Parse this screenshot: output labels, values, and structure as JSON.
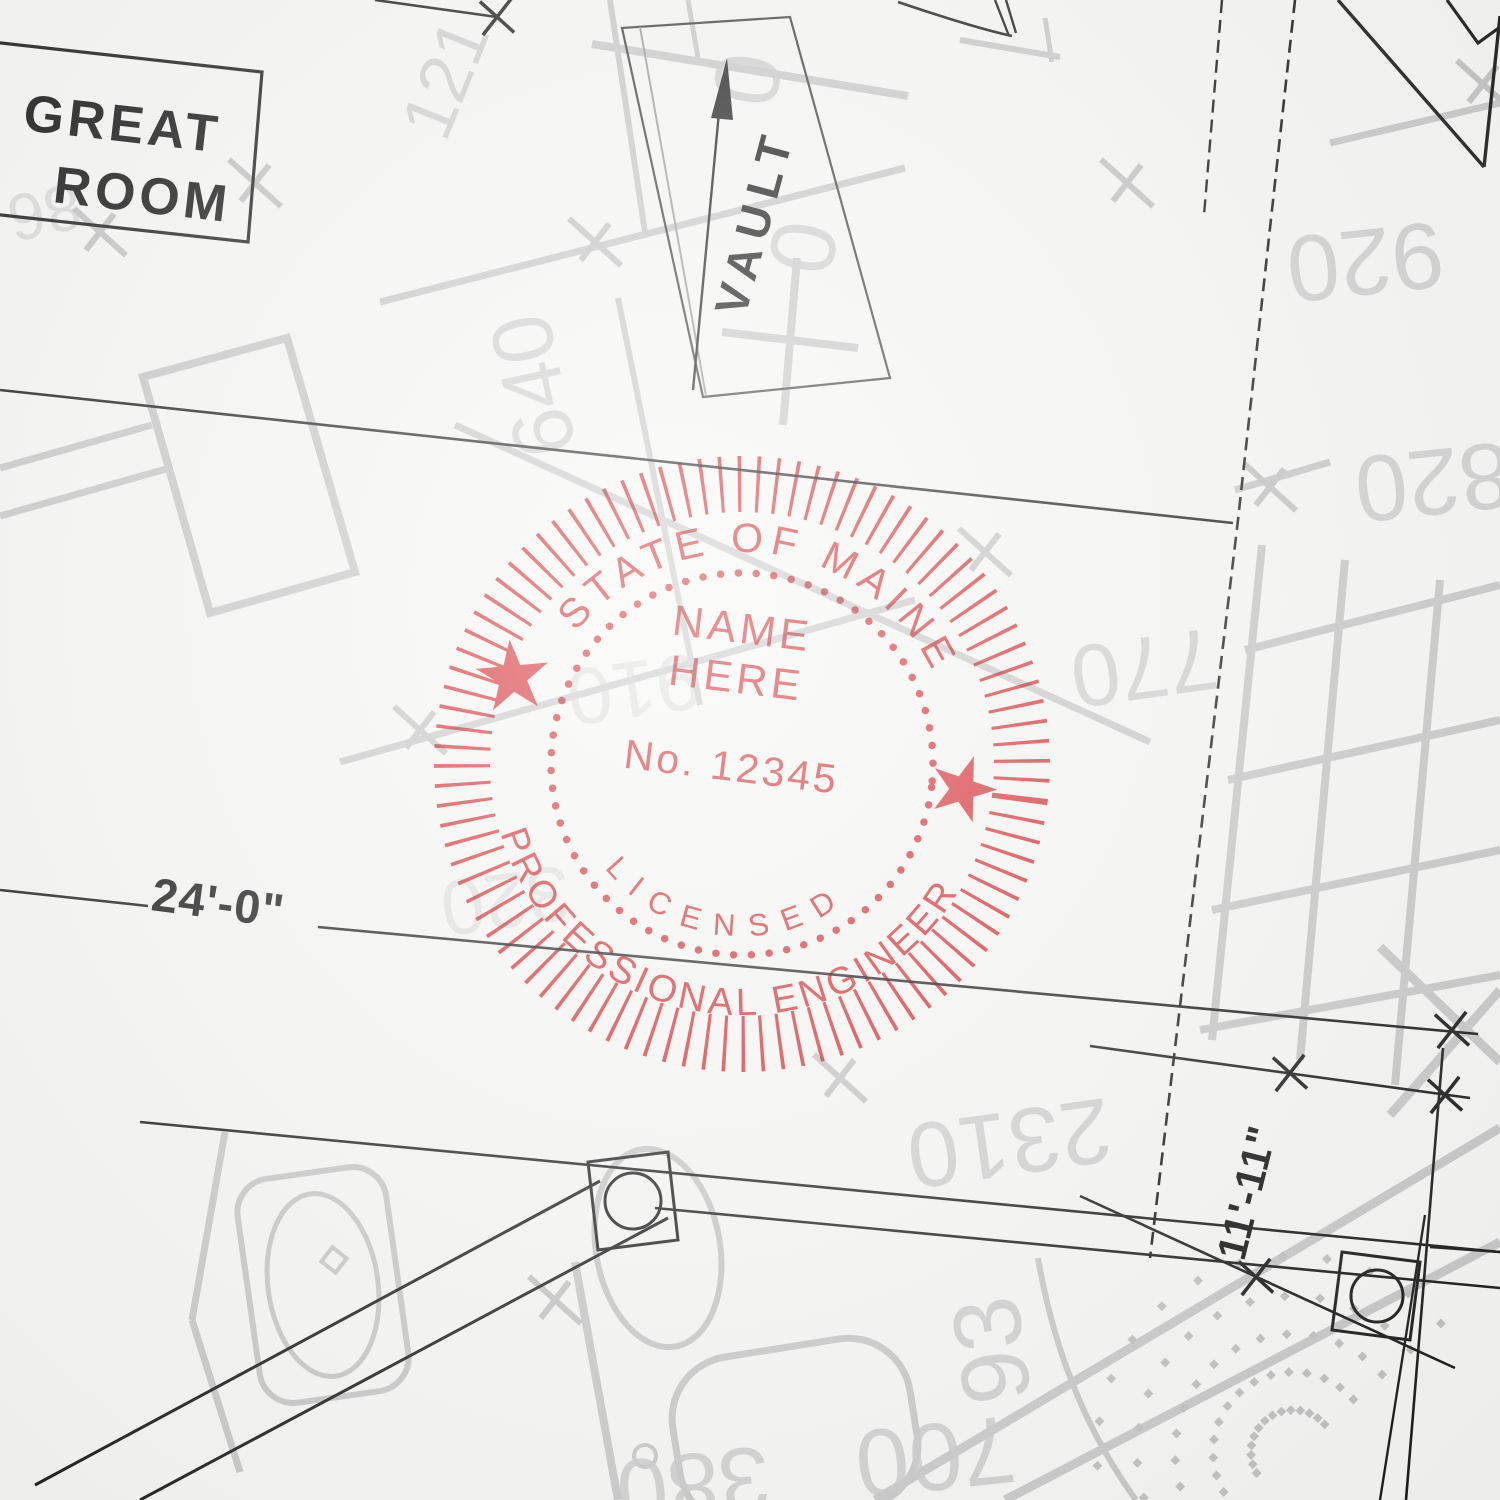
{
  "blueprint": {
    "room_label_line1": "GREAT",
    "room_label_line2": "ROOM",
    "vault_label": "VAULT",
    "dim_width": "24'-0\"",
    "dim_height": "11'-11\"",
    "ghost_numbers": [
      {
        "t": "121",
        "x": 468,
        "y": 88,
        "r": -68,
        "s": 72
      },
      {
        "t": "0",
        "x": 716,
        "y": 74,
        "r": 100,
        "s": 92
      },
      {
        "t": "0",
        "x": 772,
        "y": 242,
        "r": 100,
        "s": 92
      },
      {
        "t": "640",
        "x": 562,
        "y": 380,
        "r": -102,
        "s": 86
      },
      {
        "t": "920",
        "x": 1362,
        "y": 230,
        "r": 174,
        "s": 94
      },
      {
        "t": "820",
        "x": 1430,
        "y": 450,
        "r": 174,
        "s": 94
      },
      {
        "t": "770",
        "x": 1140,
        "y": 638,
        "r": 172,
        "s": 88
      },
      {
        "t": "910",
        "x": 630,
        "y": 662,
        "r": 172,
        "s": 80,
        "o": 0.5
      },
      {
        "t": "320",
        "x": 502,
        "y": 874,
        "r": 172,
        "s": 78,
        "o": 0.5
      },
      {
        "t": "2310",
        "x": 1005,
        "y": 1112,
        "r": 172,
        "s": 92
      },
      {
        "t": "93",
        "x": 1024,
        "y": 1346,
        "r": -98,
        "s": 96
      },
      {
        "t": "700",
        "x": 932,
        "y": 1424,
        "r": 174,
        "s": 96
      },
      {
        "t": "380",
        "x": 690,
        "y": 1454,
        "r": 174,
        "s": 92
      },
      {
        "t": "86",
        "x": 40,
        "y": 190,
        "r": 168,
        "s": 66,
        "o": 0.6
      }
    ]
  },
  "stamp": {
    "arc_top": "STATE OF MAINE",
    "center_line1": "NAME",
    "center_line2": "HERE",
    "license_number": "No. 12345",
    "arc_inner_bottom": "LICENSED",
    "arc_bottom": "PROFESSIONAL ENGINEER",
    "ink_color": "#de2027"
  },
  "decor": {
    "gray_ticks": [
      [
        255,
        183
      ],
      [
        100,
        232
      ],
      [
        420,
        730
      ],
      [
        595,
        242
      ],
      [
        985,
        552
      ],
      [
        840,
        1078
      ],
      [
        1270,
        487
      ],
      [
        1483,
        84
      ],
      [
        555,
        1300
      ],
      [
        1127,
        183
      ]
    ],
    "black_ticks": [
      [
        497,
        17
      ],
      [
        1452,
        1030
      ],
      [
        1290,
        1073
      ],
      [
        1445,
        1095
      ],
      [
        1256,
        1277
      ]
    ],
    "gray_lines": [
      [
        380,
        302,
        905,
        168,
        7
      ],
      [
        455,
        425,
        1150,
        742,
        7
      ],
      [
        340,
        762,
        915,
        600,
        7
      ],
      [
        0,
        468,
        152,
        425,
        7
      ],
      [
        0,
        516,
        166,
        469,
        7
      ],
      [
        618,
        298,
        700,
        705,
        6
      ],
      [
        592,
        44,
        908,
        96,
        8
      ],
      [
        610,
        0,
        645,
        232,
        6
      ],
      [
        688,
        0,
        698,
        58,
        5
      ],
      [
        1262,
        545,
        1212,
        1040,
        8
      ],
      [
        1345,
        560,
        1300,
        1060,
        8
      ],
      [
        1440,
        580,
        1395,
        1085,
        8
      ],
      [
        1245,
        650,
        1500,
        585,
        8
      ],
      [
        1228,
        780,
        1500,
        720,
        8
      ],
      [
        1212,
        910,
        1500,
        850,
        8
      ],
      [
        1200,
        1030,
        1500,
        975,
        8
      ],
      [
        875,
        1500,
        1500,
        1128,
        9
      ],
      [
        1005,
        1500,
        1500,
        1242,
        9
      ],
      [
        1380,
        947,
        1500,
        1062,
        9
      ],
      [
        1500,
        990,
        1390,
        1115,
        9
      ],
      [
        1330,
        143,
        1500,
        103,
        7
      ],
      [
        1235,
        490,
        1330,
        462,
        7
      ],
      [
        722,
        332,
        858,
        348,
        8
      ],
      [
        797,
        258,
        783,
        425,
        8
      ],
      [
        575,
        1262,
        618,
        1500,
        8
      ],
      [
        960,
        40,
        1060,
        57,
        6
      ],
      [
        1045,
        18,
        1052,
        62,
        5
      ],
      [
        225,
        1132,
        192,
        1320,
        7
      ],
      [
        192,
        1320,
        240,
        1472,
        7
      ]
    ],
    "patio": {
      "cx": 1293,
      "cy": 1452,
      "rings": [
        42,
        80,
        118,
        156,
        196
      ],
      "a0": 150,
      "a1": 330,
      "step": 13,
      "dot": 7
    }
  }
}
